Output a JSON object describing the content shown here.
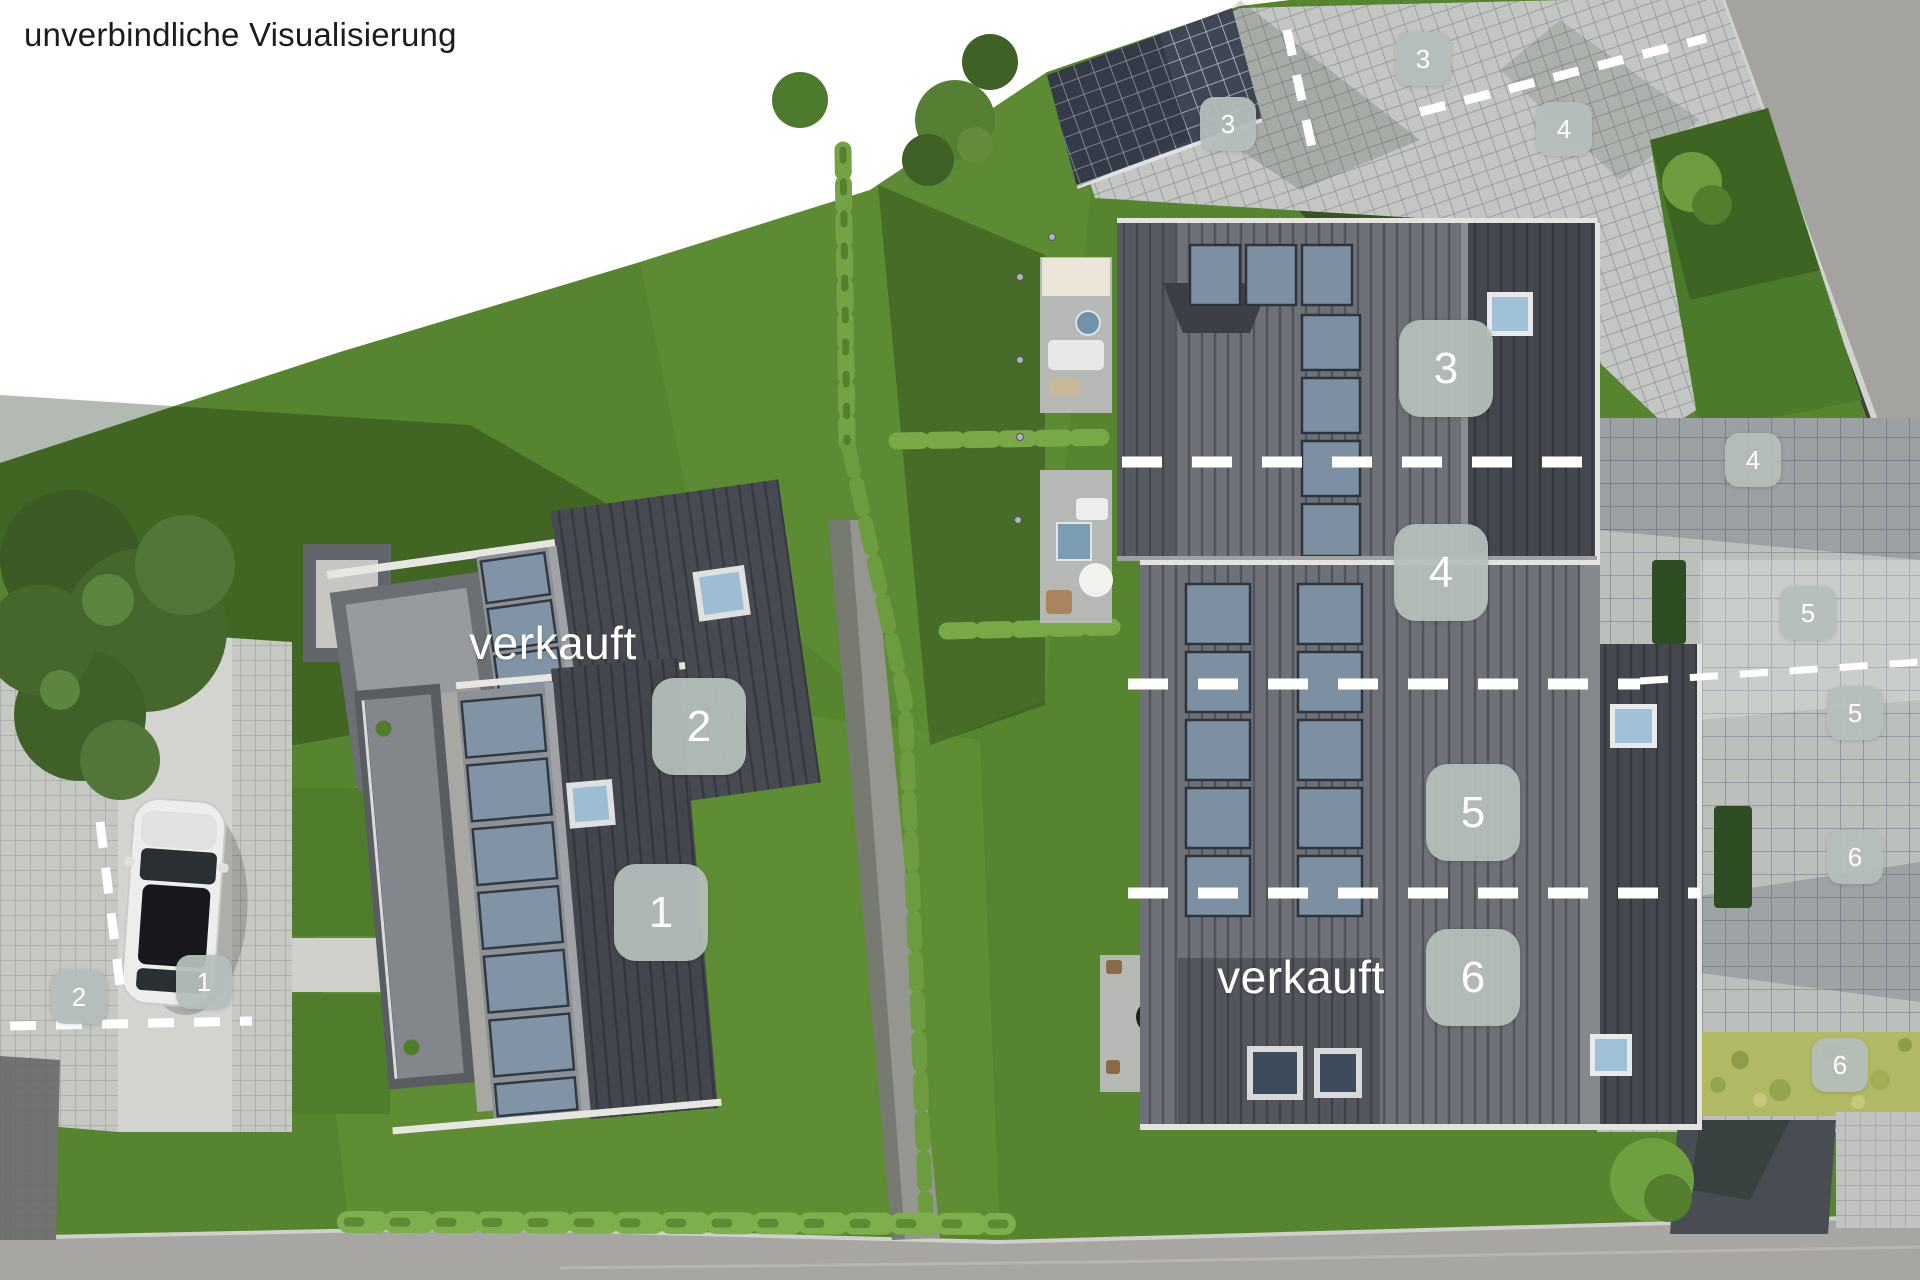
{
  "title": "unverbindliche Visualisierung",
  "sold_labels": [
    "verkauft",
    "verkauft"
  ],
  "badges": [
    {
      "label": "2",
      "area": "house-unit"
    },
    {
      "label": "1",
      "area": "house-unit"
    },
    {
      "label": "3",
      "area": "house-unit"
    },
    {
      "label": "4",
      "area": "house-unit"
    },
    {
      "label": "5",
      "area": "house-unit"
    },
    {
      "label": "6",
      "area": "house-unit"
    },
    {
      "label": "3",
      "area": "carport"
    },
    {
      "label": "3",
      "area": "parking-top"
    },
    {
      "label": "4",
      "area": "parking-top"
    },
    {
      "label": "4",
      "area": "parking-right"
    },
    {
      "label": "5",
      "area": "parking-right"
    },
    {
      "label": "5",
      "area": "parking-right"
    },
    {
      "label": "6",
      "area": "parking-right"
    },
    {
      "label": "6",
      "area": "meadow"
    },
    {
      "label": "1",
      "area": "parking-left"
    },
    {
      "label": "2",
      "area": "parking-left"
    }
  ],
  "colors": {
    "badge_bg": "#b4bcba",
    "sold_text": "#ffffff",
    "title_text": "#1c1c1c",
    "grass": "#5b8a33",
    "roof_dark": "#44484e",
    "roof_light": "#6e7177",
    "solar_panel": "#8094a6",
    "paving": "#c6c8c4",
    "road": "#a4a3a0",
    "divider_dash": "#ffffff"
  }
}
